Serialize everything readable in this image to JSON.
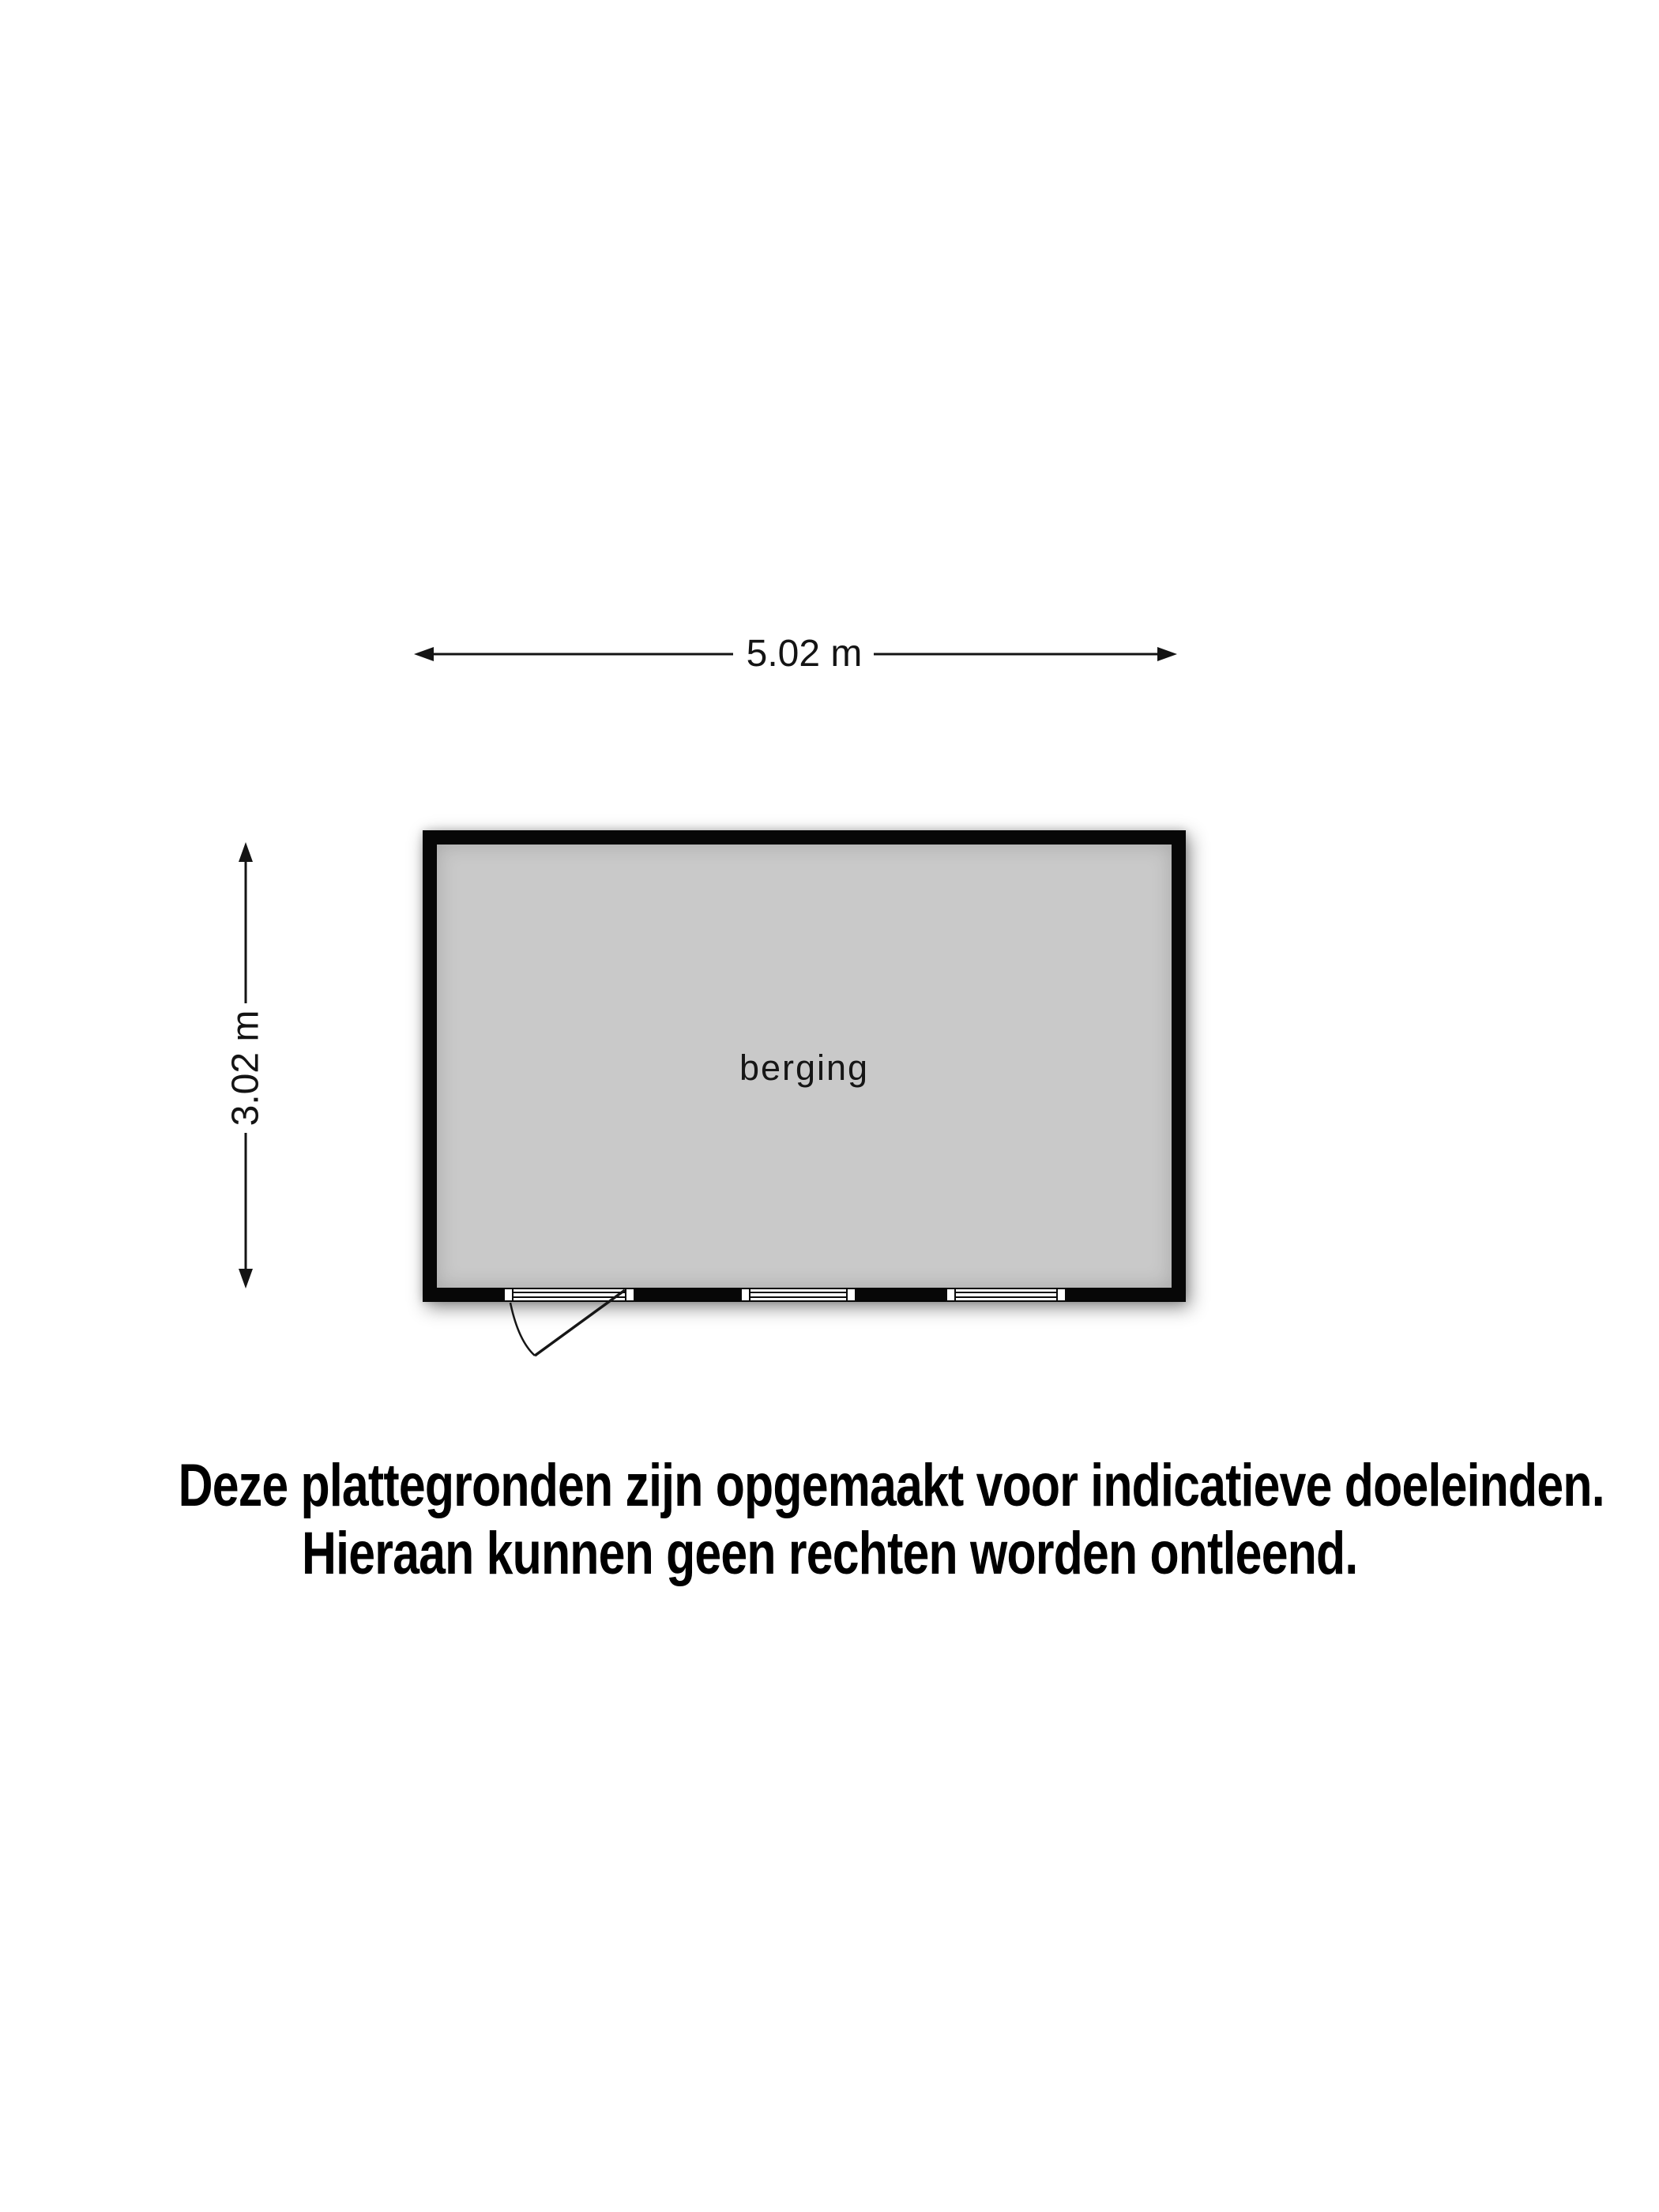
{
  "floor_plan": {
    "room": {
      "label": "berging"
    },
    "dimensions": {
      "width_label": "5.02 m",
      "height_label": "3.02 m"
    },
    "openings": {
      "door": "door-with-swing",
      "windows_count": 2
    }
  },
  "disclaimer": {
    "line1": "Deze plattegronden zijn opgemaakt voor indicatieve doeleinden.",
    "line2": "Hieraan kunnen geen rechten worden ontleend."
  },
  "colors": {
    "wall": "#070707",
    "floor_fill": "#c9c9c9",
    "line": "#141414",
    "window_fill": "#ffffff",
    "background": "#ffffff",
    "text": "#000000"
  }
}
